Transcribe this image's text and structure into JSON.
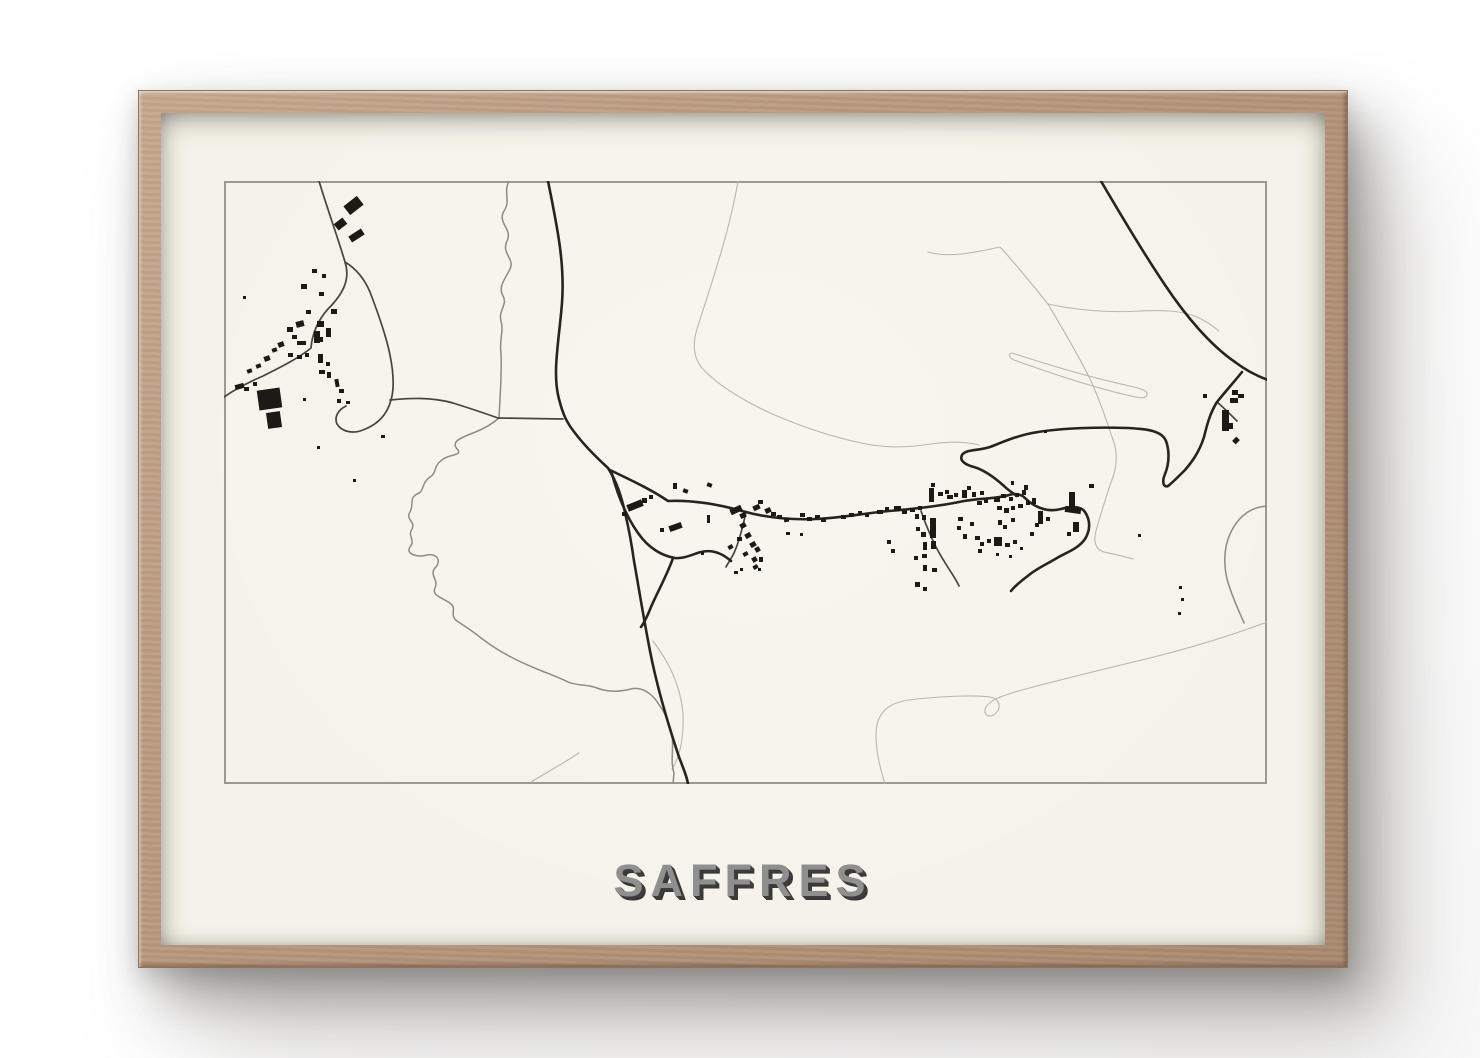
{
  "poster": {
    "title": "SAFFRES"
  },
  "frame": {
    "wood_color": "#b49379",
    "paper_color": "#f5f3e9"
  },
  "map": {
    "view_box": "223 180 1043 603",
    "border_color": "#9b9a92",
    "road_major_color": "#26241e",
    "road_minor_color": "#45443e",
    "boundary_color": "#8d8c83",
    "trail_color": "#b9b8ae",
    "building_color": "#1b1a17",
    "trails": [
      "M927,251 C947,257 972,252 999,246 C1014,262 1034,287 1047,303",
      "M1047,303 C1074,309 1108,312 1138,310 C1158,309 1180,309 1196,316 C1205,320 1212,325 1218,330",
      "M1047,303 C1060,325 1078,355 1090,380 C1098,398 1106,420 1114,445 C1117,460 1114,472 1109,484 C1104,500 1099,515 1095,530 C1092,541 1095,549 1103,551 C1112,553 1122,555 1132,558",
      "M1011,352 C1048,364 1096,378 1133,386 C1141,388 1147,390 1146,394 C1145,398 1138,397 1130,395 C1094,387 1049,372 1013,359 C1008,357 1007,353 1011,352",
      "M737,180 C729,228 712,278 696,328 C691,344 693,357 701,367 C716,384 746,402 776,415 C802,426 832,436 860,442 C888,448 910,446 930,443 C950,440 965,441 978,444",
      "M884,783 C877,760 873,741 876,723 C881,706 893,700 916,698 C945,695 974,694 989,696 C999,698 1001,707 994,713 C988,718 981,713 985,706 C989,699 1001,695 1014,691 C1049,681 1099,669 1149,657 C1189,647 1229,635 1266,621",
      "M530,781 C545,772 561,763 578,752",
      "M652,640 C667,660 679,682 682,712 C683,736 679,756 671,768"
    ],
    "boundaries": [
      "M508,180 C502,192 510,200 503,210 C496,222 512,228 506,240 C500,252 514,258 509,268 C503,280 497,286 502,295 C507,303 497,310 500,320 C503,330 498,340 500,352 C501,372 499,395 498,417",
      "M498,417 C490,424 480,429 472,432 C459,437 449,441 457,449 C461,455 447,453 441,459 C432,465 436,472 429,476 C420,482 424,490 416,493 C408,497 413,504 409,511 C404,518 415,521 411,528 C406,535 415,539 409,546 C404,553 417,557 426,554 C436,552 441,560 434,567 C428,574 438,579 434,587 C430,595 443,597 450,603 C456,608 448,614 456,620 C465,626 473,631 480,637 C492,646 500,651 510,656 C521,662 531,666 541,670 C551,674 559,677 567,681 C576,685 586,683 596,687 C606,691 618,691 630,688 C641,685 651,693 657,702 C664,712 669,722 671,734 C673,748 669,760 673,772 L672,783",
      "M1266,505 C1251,506 1239,514 1231,529 C1223,544 1222,560 1226,578 C1231,596 1238,610 1243,622"
    ],
    "roads_minor": [
      "M318,180 C327,210 337,237 344,261 C350,279 341,294 327,308 C317,319 311,333 310,347 C298,357 280,366 262,375 C246,382 233,389 223,396",
      "M344,261 C354,267 363,277 369,291 C377,312 385,334 389,354 C393,374 393,389 390,399 C386,414 376,424 362,429 C352,433 341,431 336,423 C333,416 337,409 345,405",
      "M389,399 C409,397 431,396 452,402 C468,407 483,412 497,417 L562,418",
      "M745,511 C742,525 738,541 733,552 C730,558 727,562 725,566",
      "M920,510 C926,527 934,546 943,560 C949,570 955,578 958,585",
      "M1216,401 C1223,407 1230,414 1236,420"
    ],
    "roads_major": [
      "M547,180 C556,225 564,262 561,302 C558,340 551,372 558,398 C562,414 566,422 574,432 C583,444 595,456 607,467 C616,481 621,497 625,516 C629,533 631,546 633,560 C637,582 642,614 649,650 C656,686 668,726 678,756 C683,769 686,776 687,783",
      "M1097,175 C1114,204 1139,247 1164,284 C1184,314 1209,344 1234,361 C1247,371 1258,376 1270,380",
      "M1241,371 C1233,381 1224,391 1216,401 C1209,412 1206,424 1203,436 C1198,452 1190,462 1184,469 C1176,477 1170,483 1167,485 C1162,487 1161,480 1164,473 C1169,461 1168,448 1165,440 C1161,430 1147,428 1127,427 C1097,426 1062,427 1037,431 C1017,434 1002,441 989,446 C977,450 965,448 961,454 C958,460 965,464 973,466 C983,469 993,476 1003,485 C1008,490 1012,492 1016,495",
      "M609,469 C625,477 648,487 667,500 C692,499 716,503 741,510 C766,517 792,519 815,518 C840,517 865,512 888,510 C912,508 940,505 963,500 C980,497 995,498 1008,494 C1014,492 1020,493 1024,497",
      "M1024,497 C1032,505 1045,512 1060,508 C1070,505 1080,505 1084,511 C1090,520 1089,530 1084,538 C1077,548 1066,551 1056,557 C1046,563 1035,568 1028,574 C1020,580 1014,585 1010,590",
      "M611,473 C617,495 625,515 637,532 C648,548 662,555 674,557 C683,558 692,553 700,551 C712,548 722,553 730,560",
      "M672,557 C667,572 657,590 650,606 C646,616 643,622 640,626"
    ],
    "buildings": [
      [
        344,
        199,
        17,
        11,
        -38
      ],
      [
        334,
        219,
        11,
        8,
        -38
      ],
      [
        348,
        231,
        15,
        7,
        -33
      ],
      [
        311,
        268,
        5,
        4,
        0
      ],
      [
        300,
        283,
        6,
        5,
        0
      ],
      [
        321,
        273,
        4,
        4,
        0
      ],
      [
        318,
        291,
        5,
        4,
        0
      ],
      [
        316,
        320,
        7,
        6,
        0
      ],
      [
        325,
        327,
        5,
        9,
        0
      ],
      [
        318,
        336,
        4,
        5,
        0
      ],
      [
        305,
        309,
        5,
        4,
        0
      ],
      [
        313,
        330,
        6,
        12,
        0
      ],
      [
        330,
        308,
        6,
        5,
        0
      ],
      [
        295,
        320,
        8,
        6,
        -15
      ],
      [
        286,
        326,
        6,
        5,
        0
      ],
      [
        291,
        334,
        5,
        4,
        0
      ],
      [
        296,
        340,
        9,
        4,
        0
      ],
      [
        287,
        352,
        5,
        4,
        0
      ],
      [
        296,
        354,
        5,
        4,
        0
      ],
      [
        304,
        352,
        4,
        4,
        0
      ],
      [
        317,
        353,
        5,
        9,
        0
      ],
      [
        325,
        361,
        4,
        4,
        0
      ],
      [
        318,
        369,
        6,
        4,
        0
      ],
      [
        326,
        371,
        4,
        6,
        0
      ],
      [
        277,
        341,
        6,
        5,
        -20
      ],
      [
        271,
        347,
        5,
        4,
        -20
      ],
      [
        263,
        355,
        6,
        5,
        -20
      ],
      [
        255,
        363,
        5,
        4,
        -20
      ],
      [
        246,
        368,
        5,
        4,
        -20
      ],
      [
        234,
        383,
        9,
        5,
        -15
      ],
      [
        243,
        386,
        5,
        4,
        0
      ],
      [
        252,
        381,
        4,
        4,
        0
      ],
      [
        257,
        388,
        23,
        20,
        -8
      ],
      [
        266,
        411,
        14,
        16,
        -8
      ],
      [
        334,
        378,
        4,
        8,
        -10
      ],
      [
        338,
        388,
        5,
        4,
        0
      ],
      [
        336,
        398,
        4,
        4,
        0
      ],
      [
        345,
        400,
        4,
        3,
        0
      ],
      [
        242,
        295,
        3,
        3,
        0
      ],
      [
        302,
        397,
        3,
        3,
        0
      ],
      [
        316,
        445,
        3,
        3,
        0
      ],
      [
        352,
        478,
        3,
        3,
        0
      ],
      [
        380,
        434,
        4,
        3,
        0
      ],
      [
        626,
        501,
        16,
        7,
        -22
      ],
      [
        641,
        497,
        5,
        5,
        0
      ],
      [
        648,
        494,
        4,
        4,
        0
      ],
      [
        621,
        511,
        5,
        4,
        0
      ],
      [
        672,
        482,
        4,
        6,
        0
      ],
      [
        682,
        488,
        5,
        4,
        20
      ],
      [
        706,
        482,
        5,
        4,
        20
      ],
      [
        668,
        523,
        13,
        6,
        -20
      ],
      [
        659,
        527,
        4,
        4,
        0
      ],
      [
        706,
        514,
        3,
        8,
        0
      ],
      [
        733,
        570,
        4,
        3,
        0
      ],
      [
        700,
        551,
        3,
        3,
        0
      ],
      [
        729,
        506,
        12,
        6,
        -25
      ],
      [
        739,
        512,
        6,
        5,
        -25
      ],
      [
        752,
        504,
        7,
        5,
        -25
      ],
      [
        757,
        499,
        5,
        4,
        0
      ],
      [
        764,
        507,
        6,
        5,
        -25
      ],
      [
        770,
        511,
        5,
        4,
        0
      ],
      [
        776,
        514,
        5,
        4,
        0
      ],
      [
        783,
        517,
        5,
        4,
        -10
      ],
      [
        739,
        522,
        6,
        5,
        -30
      ],
      [
        744,
        532,
        6,
        5,
        -30
      ],
      [
        736,
        536,
        5,
        4,
        0
      ],
      [
        749,
        541,
        6,
        5,
        -30
      ],
      [
        754,
        546,
        5,
        5,
        -30
      ],
      [
        742,
        551,
        5,
        4,
        -30
      ],
      [
        751,
        556,
        5,
        5,
        -30
      ],
      [
        727,
        544,
        5,
        4,
        -30
      ],
      [
        758,
        556,
        4,
        5,
        0
      ],
      [
        752,
        564,
        5,
        4,
        -30
      ],
      [
        799,
        512,
        5,
        4,
        0
      ],
      [
        806,
        516,
        5,
        4,
        0
      ],
      [
        814,
        514,
        5,
        3,
        0
      ],
      [
        820,
        517,
        5,
        4,
        0
      ],
      [
        785,
        531,
        4,
        3,
        0
      ],
      [
        799,
        532,
        3,
        3,
        0
      ],
      [
        739,
        567,
        3,
        3,
        0
      ],
      [
        757,
        567,
        3,
        3,
        0
      ],
      [
        840,
        514,
        5,
        4,
        0
      ],
      [
        848,
        512,
        5,
        4,
        0
      ],
      [
        857,
        510,
        4,
        4,
        0
      ],
      [
        864,
        513,
        4,
        3,
        0
      ],
      [
        876,
        509,
        6,
        4,
        0
      ],
      [
        884,
        506,
        4,
        4,
        0
      ],
      [
        893,
        505,
        7,
        5,
        0
      ],
      [
        901,
        509,
        5,
        4,
        0
      ],
      [
        909,
        507,
        5,
        4,
        0
      ],
      [
        917,
        505,
        4,
        4,
        0
      ],
      [
        914,
        513,
        4,
        5,
        0
      ],
      [
        921,
        514,
        4,
        5,
        0
      ],
      [
        928,
        487,
        5,
        14,
        0
      ],
      [
        937,
        491,
        5,
        4,
        0
      ],
      [
        944,
        489,
        4,
        4,
        0
      ],
      [
        930,
        482,
        4,
        4,
        0
      ],
      [
        915,
        526,
        4,
        4,
        0
      ],
      [
        920,
        531,
        5,
        5,
        0
      ],
      [
        922,
        541,
        4,
        8,
        0
      ],
      [
        929,
        517,
        6,
        20,
        0
      ],
      [
        930,
        540,
        5,
        8,
        0
      ],
      [
        921,
        553,
        5,
        4,
        0
      ],
      [
        913,
        555,
        4,
        4,
        0
      ],
      [
        922,
        564,
        4,
        6,
        0
      ],
      [
        931,
        567,
        5,
        4,
        0
      ],
      [
        914,
        581,
        5,
        5,
        0
      ],
      [
        922,
        586,
        4,
        4,
        0
      ],
      [
        886,
        539,
        4,
        4,
        0
      ],
      [
        890,
        548,
        4,
        4,
        0
      ],
      [
        946,
        494,
        6,
        4,
        0
      ],
      [
        953,
        492,
        4,
        4,
        0
      ],
      [
        961,
        489,
        5,
        8,
        0
      ],
      [
        966,
        485,
        4,
        4,
        0
      ],
      [
        971,
        491,
        4,
        5,
        0
      ],
      [
        979,
        490,
        4,
        4,
        0
      ],
      [
        976,
        500,
        5,
        4,
        0
      ],
      [
        983,
        498,
        4,
        4,
        0
      ],
      [
        957,
        516,
        5,
        4,
        0
      ],
      [
        956,
        525,
        4,
        4,
        0
      ],
      [
        969,
        521,
        4,
        4,
        0
      ],
      [
        962,
        533,
        4,
        5,
        0
      ],
      [
        974,
        535,
        5,
        4,
        0
      ],
      [
        979,
        541,
        4,
        4,
        0
      ],
      [
        986,
        538,
        4,
        4,
        0
      ],
      [
        977,
        548,
        4,
        4,
        0
      ],
      [
        993,
        496,
        6,
        5,
        0
      ],
      [
        1000,
        493,
        5,
        4,
        0
      ],
      [
        1008,
        496,
        4,
        4,
        0
      ],
      [
        1014,
        492,
        4,
        4,
        0
      ],
      [
        1021,
        489,
        4,
        5,
        0
      ],
      [
        996,
        505,
        5,
        4,
        0
      ],
      [
        1003,
        507,
        5,
        5,
        0
      ],
      [
        1010,
        505,
        4,
        4,
        0
      ],
      [
        1017,
        503,
        5,
        4,
        0
      ],
      [
        1025,
        500,
        4,
        4,
        0
      ],
      [
        1031,
        497,
        4,
        6,
        0
      ],
      [
        997,
        519,
        4,
        5,
        0
      ],
      [
        1002,
        524,
        4,
        4,
        0
      ],
      [
        1010,
        517,
        4,
        4,
        0
      ],
      [
        993,
        536,
        8,
        9,
        0
      ],
      [
        1004,
        542,
        5,
        4,
        0
      ],
      [
        1012,
        539,
        4,
        4,
        0
      ],
      [
        995,
        552,
        3,
        3,
        0
      ],
      [
        1008,
        554,
        3,
        3,
        0
      ],
      [
        1019,
        546,
        3,
        3,
        0
      ],
      [
        1029,
        531,
        4,
        4,
        0
      ],
      [
        1034,
        522,
        4,
        4,
        0
      ],
      [
        1037,
        510,
        5,
        13,
        0
      ],
      [
        1045,
        516,
        4,
        4,
        0
      ],
      [
        1068,
        491,
        6,
        17,
        0
      ],
      [
        1064,
        506,
        16,
        6,
        8
      ],
      [
        1072,
        521,
        6,
        10,
        0
      ],
      [
        1066,
        531,
        4,
        4,
        0
      ],
      [
        1088,
        483,
        5,
        4,
        0
      ],
      [
        1043,
        429,
        3,
        3,
        0
      ],
      [
        1137,
        533,
        3,
        3,
        0
      ],
      [
        1010,
        480,
        3,
        4,
        0
      ],
      [
        1023,
        484,
        4,
        5,
        0
      ],
      [
        1202,
        393,
        4,
        4,
        0
      ],
      [
        1231,
        389,
        6,
        5,
        0
      ],
      [
        1229,
        397,
        8,
        5,
        0
      ],
      [
        1237,
        393,
        6,
        4,
        0
      ],
      [
        1221,
        409,
        7,
        21,
        0
      ],
      [
        1228,
        422,
        4,
        6,
        0
      ],
      [
        1232,
        437,
        6,
        5,
        -45
      ],
      [
        1178,
        585,
        3,
        3,
        0
      ],
      [
        1180,
        597,
        3,
        3,
        0
      ],
      [
        1177,
        611,
        3,
        3,
        0
      ]
    ]
  }
}
